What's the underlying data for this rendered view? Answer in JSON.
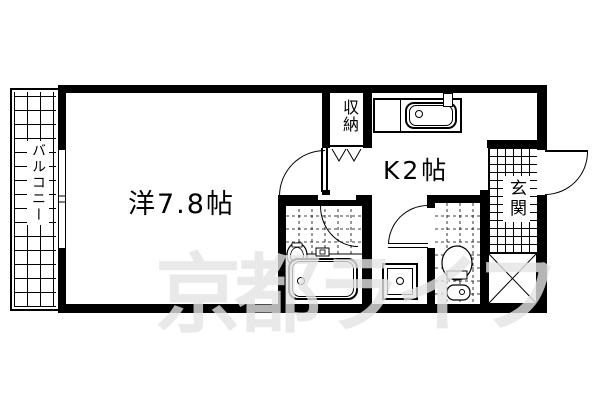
{
  "plan_title": "apartment-floor-plan",
  "rooms": {
    "balcony": {
      "label": "バルコニー"
    },
    "western_room": {
      "label": "洋7.8帖"
    },
    "kitchen": {
      "label": "K2帖"
    },
    "closet": {
      "label": "収納"
    },
    "entrance": {
      "label": "玄関"
    }
  },
  "watermark": {
    "text": "京都ライフ"
  },
  "fixtures": {
    "kitchen_sink": "kitchen-sink",
    "bathtub": "bathtub",
    "washbasin": "washbasin",
    "toilet": "toilet",
    "washing_machine_pan": "washing-machine-pan",
    "pipe_space": "pipe-space-x",
    "closet_folding_door": "folding-door",
    "window": "sliding-window"
  },
  "colors": {
    "wall": "#000000",
    "line": "#000000",
    "background": "#ffffff",
    "watermark_on_white": "#ebebeb"
  }
}
